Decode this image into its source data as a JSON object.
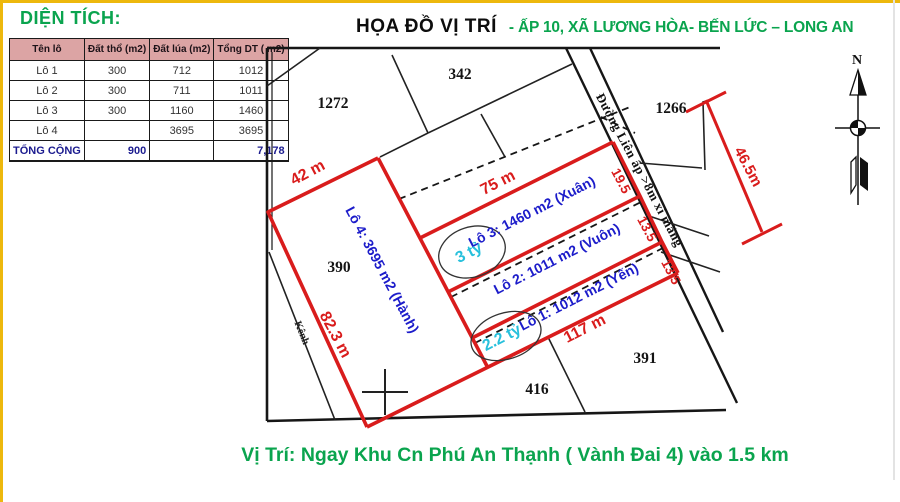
{
  "area_panel": {
    "title": "DIỆN TÍCH:",
    "table": {
      "headers": [
        "Tên lô",
        "Đất thổ (m2)",
        "Đất lúa (m2)",
        "Tổng DT ( m2)"
      ],
      "rows": [
        [
          "Lô 1",
          "300",
          "712",
          "1012"
        ],
        [
          "Lô 2",
          "300",
          "711",
          "1011"
        ],
        [
          "Lô 3",
          "300",
          "1160",
          "1460"
        ],
        [
          "Lô 4",
          "",
          "3695",
          "3695"
        ]
      ],
      "total_row": [
        "TỔNG CỘNG",
        "900",
        "",
        "7,178"
      ]
    }
  },
  "header": {
    "title": "HỌA ĐỒ VỊ TRÍ",
    "subtitle": "- ẤP 10, XÃ LƯƠNG HÒA- BẾN LỨC – LONG AN"
  },
  "map": {
    "parcel_342": "342",
    "parcel_1272": "1272",
    "parcel_1266": "1266",
    "parcel_390": "390",
    "parcel_416": "416",
    "parcel_391": "391",
    "dim_42": "42 m",
    "dim_75": "75 m",
    "dim_117": "117 m",
    "dim_82_3": "82.3 m",
    "dim_46_5": "46.5m",
    "dim_19_5": "19.5",
    "dim_13_5_a": "13.5",
    "dim_13_5_b": "13.5",
    "lot4_label": "Lô 4: 3695 m2 (Hành)",
    "lot3_label": "Lô 3: 1460 m2 (Xuân)",
    "lot2_label": "Lô 2: 1011 m2 (Vuôn)",
    "lot1_label": "Lô 1: 1012 m2 (Yến)",
    "price_lot3": "3 tỷ",
    "price_lot1": "2.2 tỷ",
    "road_label": "Đường Liên ấp >8m xi măng",
    "canal_label": "Kênh",
    "compass_n": "N"
  },
  "footer": {
    "caption": "Vị Trí: Ngay Khu Cn Phú An Thạnh ( Vành Đai 4) vào 1.5 km"
  },
  "colors": {
    "accent_green": "#0aa44e",
    "map_red": "#d91c1c",
    "lot_blue": "#1c1cca",
    "price_cyan": "#27c0dc",
    "total_navy": "#1b1b8f",
    "table_header_pink": "#dca4a4",
    "frame_yellow": "#edb80d"
  }
}
